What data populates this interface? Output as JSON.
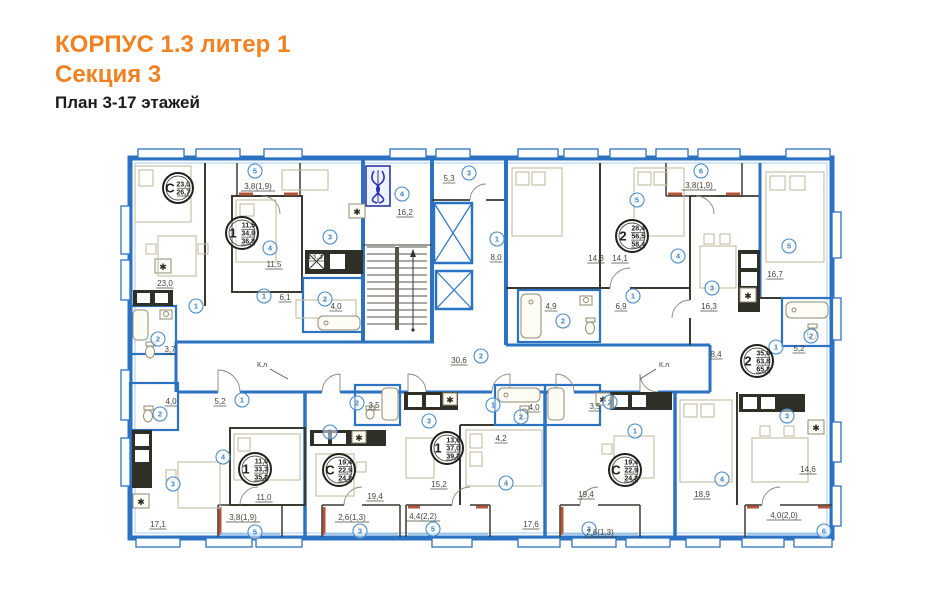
{
  "title": {
    "line1": "КОРПУС 1.3 литер 1",
    "line2": "Секция 3",
    "line3": "План 3-17 этажей"
  },
  "colors": {
    "accent_orange": "#f08221",
    "wall_blue": "#2c72c2",
    "wall_dark": "#3a3a31",
    "terracotta": "#b2553c",
    "paper_cream": "#f9f7e8",
    "circle_blue": "#3f82c4",
    "badge_black": "#21211c",
    "emblem_blue": "#2b32b4"
  },
  "plan": {
    "apartments": [
      {
        "name": "studio-top-left",
        "type": "С",
        "areas": [
          "23,0",
          "26,7"
        ],
        "cx": 178,
        "cy": 188,
        "r": 15
      },
      {
        "name": "one-room-top",
        "type": "1",
        "areas": [
          "11,5",
          "34,9",
          "36,8"
        ],
        "cx": 242,
        "cy": 233,
        "r": 16
      },
      {
        "name": "two-room-top-right",
        "type": "2",
        "areas": [
          "28,4",
          "56,5",
          "58,4"
        ],
        "cx": 632,
        "cy": 236,
        "r": 16
      },
      {
        "name": "two-room-right",
        "type": "2",
        "areas": [
          "35,6",
          "63,8",
          "65,8"
        ],
        "cx": 757,
        "cy": 361,
        "r": 16
      },
      {
        "name": "one-room-bottom-left",
        "type": "1",
        "areas": [
          "11,0",
          "33,3",
          "35,2"
        ],
        "cx": 255,
        "cy": 469,
        "r": 16
      },
      {
        "name": "studio-bottom-left",
        "type": "С",
        "areas": [
          "19,4",
          "22,9",
          "24,2"
        ],
        "cx": 339,
        "cy": 470,
        "r": 16
      },
      {
        "name": "one-room-bottom-middle",
        "type": "1",
        "areas": [
          "13,6",
          "37,0",
          "39,2"
        ],
        "cx": 447,
        "cy": 448,
        "r": 16
      },
      {
        "name": "studio-bottom-right",
        "type": "С",
        "areas": [
          "19,4",
          "22,9",
          "24,2"
        ],
        "cx": 625,
        "cy": 470,
        "r": 16
      }
    ],
    "rooms": [
      {
        "name": "tl-studio-living",
        "n": "1",
        "area": "23,0",
        "cx": 196,
        "cy": 306,
        "lx": 165,
        "ly": 286
      },
      {
        "name": "tl-studio-bath",
        "n": "2",
        "area": "3,7",
        "cx": 158,
        "cy": 339,
        "lx": 170,
        "ly": 352
      },
      {
        "name": "apt1-balcony",
        "n": "5",
        "area": "3,8(1,9)",
        "cx": 255,
        "cy": 171,
        "lx": 258,
        "ly": 189
      },
      {
        "name": "apt1-bedroom",
        "n": "4",
        "area": "11,5",
        "cx": 270,
        "cy": 248,
        "lx": 274,
        "ly": 267
      },
      {
        "name": "apt1-kitchen",
        "n": "3",
        "area": "13,3",
        "cx": 330,
        "cy": 237,
        "lx": 315,
        "ly": 259
      },
      {
        "name": "apt1-hall",
        "n": "1",
        "area": "6,1",
        "cx": 264,
        "cy": 296,
        "lx": 285,
        "ly": 300
      },
      {
        "name": "apt1-bath",
        "n": "2",
        "area": "4,0",
        "cx": 325,
        "cy": 299,
        "lx": 336,
        "ly": 309
      },
      {
        "name": "core-lobby",
        "n": "4",
        "area": "16,2",
        "cx": 402,
        "cy": 194,
        "lx": 405,
        "ly": 215
      },
      {
        "name": "core-vestibule",
        "n": "3",
        "area": "5,3",
        "cx": 469,
        "cy": 173,
        "lx": 449,
        "ly": 181
      },
      {
        "name": "core-lift-hall",
        "n": "1",
        "area": "8,0",
        "cx": 497,
        "cy": 239,
        "lx": 496,
        "ly": 260
      },
      {
        "name": "corridor",
        "n": "2",
        "area": "30,6",
        "cx": 481,
        "cy": 356,
        "lx": 459,
        "ly": 363
      },
      {
        "name": "tr-bedroom-1",
        "n": "5",
        "area": "14,3",
        "cx": 637,
        "cy": 200,
        "lx": 596,
        "ly": 261
      },
      {
        "name": "tr-bedroom-2",
        "n": "4",
        "area": "14,1",
        "cx": 678,
        "cy": 256,
        "lx": 620,
        "ly": 261
      },
      {
        "name": "tr-balcony",
        "n": "6",
        "area": "3,8(1,9)",
        "cx": 701,
        "cy": 171,
        "lx": 699,
        "ly": 188
      },
      {
        "name": "tr-hall",
        "n": "1",
        "area": "6,9",
        "cx": 633,
        "cy": 296,
        "lx": 621,
        "ly": 309
      },
      {
        "name": "tr-kitchen",
        "n": "3",
        "area": "16,3",
        "cx": 712,
        "cy": 288,
        "lx": 709,
        "ly": 309
      },
      {
        "name": "tr-bath",
        "n": "2",
        "area": "4,9",
        "cx": 563,
        "cy": 321,
        "lx": 551,
        "ly": 309
      },
      {
        "name": "big-bedroom-1",
        "n": "5",
        "area": "16,7",
        "cx": 789,
        "cy": 246,
        "lx": 775,
        "ly": 277
      },
      {
        "name": "big-bath",
        "n": "2",
        "area": "5,2",
        "cx": 811,
        "cy": 336,
        "lx": 799,
        "ly": 351
      },
      {
        "name": "big-hall",
        "n": "1",
        "area": "8,4",
        "cx": 776,
        "cy": 347,
        "lx": 716,
        "ly": 357
      },
      {
        "name": "big-kitchen",
        "n": "3",
        "area": "14,6",
        "cx": 787,
        "cy": 416,
        "lx": 808,
        "ly": 472
      },
      {
        "name": "big-bedroom-2",
        "n": "4",
        "area": "18,9",
        "cx": 722,
        "cy": 479,
        "lx": 702,
        "ly": 497
      },
      {
        "name": "big-balcony",
        "n": "6",
        "area": "4,0(2,0)",
        "cx": 824,
        "cy": 531,
        "lx": 784,
        "ly": 518
      },
      {
        "name": "bl-bath",
        "n": "2",
        "area": "4,0",
        "cx": 160,
        "cy": 414,
        "lx": 171,
        "ly": 404
      },
      {
        "name": "bl-hall",
        "n": "1",
        "area": "5,2",
        "cx": 242,
        "cy": 400,
        "lx": 220,
        "ly": 404
      },
      {
        "name": "bl-living-kitchen",
        "n": "3",
        "area": "17,1",
        "cx": 173,
        "cy": 484,
        "lx": 158,
        "ly": 527
      },
      {
        "name": "bl-bedroom",
        "n": "4",
        "area": "11,0",
        "cx": 223,
        "cy": 457,
        "lx": 264,
        "ly": 500
      },
      {
        "name": "bl-balcony",
        "n": "5",
        "area": "3,8(1,9)",
        "cx": 255,
        "cy": 532,
        "lx": 243,
        "ly": 520
      },
      {
        "name": "ls-bath",
        "n": "2",
        "area": "3,5",
        "cx": 357,
        "cy": 403,
        "lx": 374,
        "ly": 408
      },
      {
        "name": "ls-living",
        "n": "1",
        "area": "19,4",
        "cx": 330,
        "cy": 432,
        "lx": 375,
        "ly": 499
      },
      {
        "name": "ls-balcony",
        "n": "3",
        "area": "2,6(1,3)",
        "cx": 360,
        "cy": 531,
        "lx": 352,
        "ly": 520
      },
      {
        "name": "m-kitchen",
        "n": "3",
        "area": "15,2",
        "cx": 429,
        "cy": 421,
        "lx": 439,
        "ly": 487
      },
      {
        "name": "m-hall",
        "n": "1",
        "area": "4,2",
        "cx": 493,
        "cy": 405,
        "lx": 501,
        "ly": 441
      },
      {
        "name": "m-bath",
        "n": "2",
        "area": "4,0",
        "cx": 521,
        "cy": 417,
        "lx": 534,
        "ly": 410
      },
      {
        "name": "m-bedroom",
        "n": "4",
        "area": "17,6",
        "cx": 506,
        "cy": 483,
        "lx": 531,
        "ly": 527
      },
      {
        "name": "m-balcony",
        "n": "5",
        "area": "4,4(2,2)",
        "cx": 433,
        "cy": 529,
        "lx": 423,
        "ly": 519
      },
      {
        "name": "rs-bath",
        "n": "2",
        "area": "3,5",
        "cx": 610,
        "cy": 402,
        "lx": 595,
        "ly": 409
      },
      {
        "name": "rs-living",
        "n": "1",
        "area": "19,4",
        "cx": 635,
        "cy": 431,
        "lx": 586,
        "ly": 497
      },
      {
        "name": "rs-balcony",
        "n": "3",
        "area": "2,6(1,3)",
        "cx": 589,
        "cy": 529,
        "lx": 600,
        "ly": 535
      }
    ],
    "annotations": [
      {
        "name": "fire-valve-left",
        "text": "К.л",
        "x": 262,
        "y": 367
      },
      {
        "name": "fire-valve-right",
        "text": "К.л",
        "x": 664,
        "y": 367
      }
    ]
  }
}
